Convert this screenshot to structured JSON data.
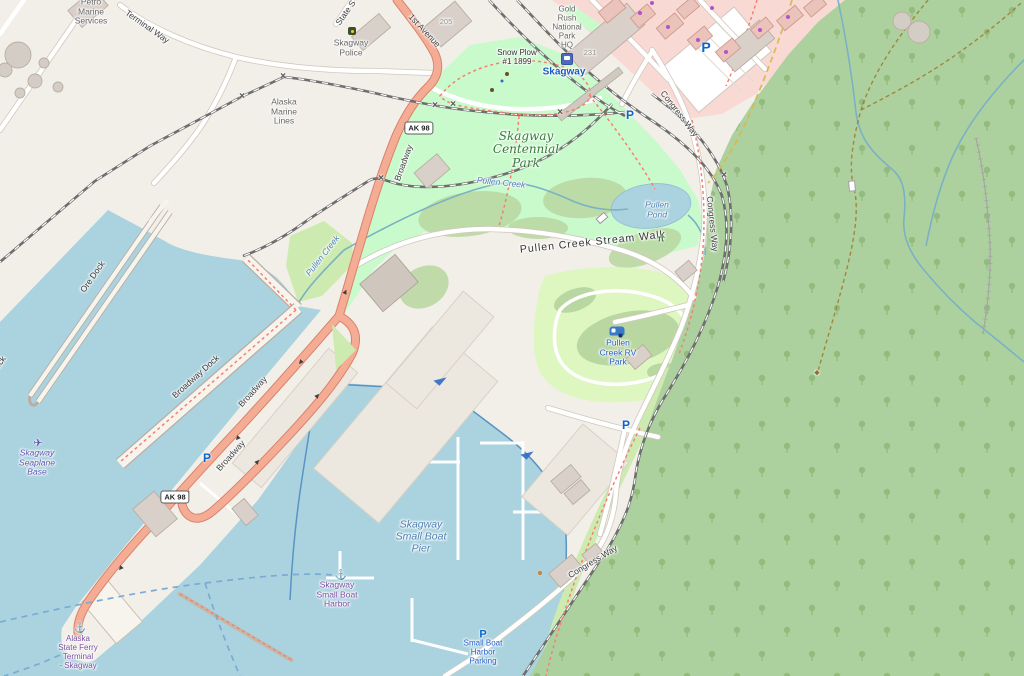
{
  "map": {
    "palette": {
      "land": "#f2efe9",
      "water": "#aad3df",
      "forest": "#add19e",
      "park": "#c8facc",
      "grass": "#cdebb0",
      "scrub": "#b9d7a0",
      "camp_site": "#def6c0",
      "retail_zone": "#f9d9d3",
      "trunk_road": "#f5ac94",
      "minor_road": "#ffffff",
      "building": "#d9d0c9",
      "railway": "#6e6e6e",
      "footpath_dash": "#f87f6f",
      "trail_dash": "#a07830",
      "ferry_route": "#7babd4",
      "parking_blue": "#0a66cc",
      "seamark_purple": "#7a4fa3"
    },
    "labels": [
      {
        "name": "label-petro-marine-services",
        "text": "Petro\nMarine\nServices",
        "x": 91,
        "y": 12,
        "cls": "",
        "size": 8.5
      },
      {
        "name": "label-terminal-way",
        "text": "Terminal Way",
        "x": 147,
        "y": 27,
        "rot": 35,
        "cls": "road"
      },
      {
        "name": "label-state-street",
        "text": "State S",
        "x": 346,
        "y": 13,
        "rot": -55,
        "cls": "road"
      },
      {
        "name": "label-1st-avenue",
        "text": "1st Avenue",
        "x": 424,
        "y": 31,
        "rot": 47,
        "cls": "road"
      },
      {
        "name": "label-alaska-marine-lines",
        "text": "Alaska\nMarine\nLines",
        "x": 284,
        "y": 112,
        "cls": ""
      },
      {
        "name": "label-skagway-police",
        "text": "Skagway\nPolice",
        "x": 351,
        "y": 48,
        "cls": ""
      },
      {
        "name": "label-housenumber-205",
        "text": "205",
        "x": 446,
        "y": 22,
        "cls": "num",
        "size": 7.5
      },
      {
        "name": "label-housenumber-231",
        "text": "231",
        "x": 590,
        "y": 53,
        "cls": "num",
        "size": 7.5
      },
      {
        "name": "label-gold-rush-national-park-hq",
        "text": "Gold\nRush\nNational\nPark\nHQ",
        "x": 567,
        "y": 28,
        "cls": "",
        "size": 8
      },
      {
        "name": "label-skagway-station",
        "text": "Skagway",
        "x": 564,
        "y": 72,
        "cls": "station",
        "size": 10
      },
      {
        "name": "label-snow-plow",
        "text": "Snow Plow\n#1 1899",
        "x": 517,
        "y": 58,
        "cls": "dark",
        "size": 8
      },
      {
        "name": "label-congress-way-north",
        "text": "Congress Way",
        "x": 679,
        "y": 114,
        "rot": 52,
        "cls": "road"
      },
      {
        "name": "label-congress-way-mid",
        "text": "Congress Way",
        "x": 712,
        "y": 224,
        "rot": 84,
        "cls": "road"
      },
      {
        "name": "label-congress-way-south",
        "text": "Congress Way",
        "x": 593,
        "y": 562,
        "rot": -31,
        "cls": "road"
      },
      {
        "name": "label-skagway-centennial-park",
        "text": "Skagway\nCentennial\nPark",
        "x": 526,
        "y": 150,
        "cls": "park",
        "size": 12
      },
      {
        "name": "label-pullen-creek-upper",
        "text": "Pullen Creek",
        "x": 501,
        "y": 183,
        "rot": 6,
        "cls": "water"
      },
      {
        "name": "label-pullen-creek-lower",
        "text": "Pullen Creek",
        "x": 323,
        "y": 256,
        "rot": -52,
        "cls": "water"
      },
      {
        "name": "label-pullen-pond",
        "text": "Pullen\nPond",
        "x": 657,
        "y": 210,
        "cls": "water"
      },
      {
        "name": "label-pullen-creek-stream-walk",
        "text": "Pullen Creek Stream Walk",
        "x": 593,
        "y": 243,
        "rot": -6,
        "cls": "dark",
        "size": 10.5,
        "ls": 1
      },
      {
        "name": "label-pullen-creek-rv-park",
        "text": "Pullen\nCreek RV\nPark",
        "x": 618,
        "y": 353,
        "cls": "transport"
      },
      {
        "name": "label-ore-dock",
        "text": "Ore Dock",
        "x": 93,
        "y": 277,
        "rot": -55,
        "cls": "dark"
      },
      {
        "name": "label-ore-dock-2",
        "text": "Ore Dock",
        "x": -6,
        "y": 372,
        "rot": -55,
        "cls": "dark"
      },
      {
        "name": "label-broadway-dock",
        "text": "Broadway Dock",
        "x": 196,
        "y": 377,
        "rot": -42,
        "cls": "dark"
      },
      {
        "name": "label-broadway-upper",
        "text": "Broadway",
        "x": 404,
        "y": 163,
        "rot": -70,
        "cls": "road"
      },
      {
        "name": "label-broadway-mid",
        "text": "Broadway",
        "x": 253,
        "y": 392,
        "rot": -48,
        "cls": "road"
      },
      {
        "name": "label-broadway-lower",
        "text": "Broadway",
        "x": 231,
        "y": 456,
        "rot": -48,
        "cls": "road"
      },
      {
        "name": "label-skagway-seaplane-base",
        "text": "Skagway\nSeaplane\nBase",
        "x": 37,
        "y": 463,
        "cls": "seaplane"
      },
      {
        "name": "label-alaska-state-ferry-terminal",
        "text": "Alaska\nState Ferry\nTerminal\n- Skagway",
        "x": 78,
        "y": 653,
        "cls": "seamark",
        "size": 8
      },
      {
        "name": "label-skagway-small-boat-harbor",
        "text": "Skagway\nSmall Boat\nHarbor",
        "x": 337,
        "y": 595,
        "cls": "seamark"
      },
      {
        "name": "label-skagway-small-boat-pier",
        "text": "Skagway\nSmall Boat\nPier",
        "x": 421,
        "y": 537,
        "cls": "water-big",
        "size": 10.5
      },
      {
        "name": "label-small-boat-harbor-parking",
        "text": "Small Boat\nHarbor\nParking",
        "x": 483,
        "y": 653,
        "cls": "transport",
        "size": 8
      }
    ],
    "shields": [
      {
        "name": "ak98-shield-north",
        "text": "AK 98",
        "x": 419,
        "y": 128
      },
      {
        "name": "ak98-shield-south",
        "text": "AK 98",
        "x": 175,
        "y": 497
      }
    ],
    "icons": [
      {
        "name": "parking-icon",
        "type": "parking",
        "text": "P",
        "x": 706,
        "y": 47,
        "size": 14
      },
      {
        "name": "parking-icon",
        "type": "parking",
        "text": "P",
        "x": 630,
        "y": 115,
        "size": 12
      },
      {
        "name": "parking-icon",
        "type": "parking",
        "text": "P",
        "x": 207,
        "y": 458,
        "size": 12
      },
      {
        "name": "parking-icon",
        "type": "parking",
        "text": "P",
        "x": 626,
        "y": 425,
        "size": 12
      },
      {
        "name": "parking-icon",
        "type": "parking",
        "text": "P",
        "x": 483,
        "y": 635,
        "size": 11
      },
      {
        "name": "police-icon",
        "type": "police",
        "x": 352,
        "y": 31
      },
      {
        "name": "train-station-icon",
        "type": "station",
        "x": 567,
        "y": 59
      },
      {
        "name": "seaplane-icon",
        "type": "glyph",
        "glyph": "✈",
        "color": "#5b55b0",
        "x": 38,
        "y": 444,
        "size": 11
      },
      {
        "name": "anchor-icon-ferry-terminal",
        "type": "glyph",
        "glyph": "⚓",
        "color": "#7a4fa3",
        "x": 80,
        "y": 629,
        "size": 10
      },
      {
        "name": "anchor-icon-small-boat-harbor",
        "type": "glyph",
        "glyph": "⚓",
        "color": "#7a4fa3",
        "x": 341,
        "y": 576,
        "size": 10
      },
      {
        "name": "caravan-icon",
        "type": "caravan",
        "x": 617,
        "y": 331
      },
      {
        "name": "picnic-table-icon",
        "type": "glyph",
        "glyph": "π",
        "color": "#3e7d3e",
        "x": 661,
        "y": 239,
        "size": 9,
        "bold": true
      },
      {
        "name": "slipway-icon",
        "type": "slipway",
        "x": 440,
        "y": 379
      },
      {
        "name": "slipway-icon",
        "type": "slipway",
        "x": 527,
        "y": 453
      },
      {
        "name": "artwork-icon",
        "type": "glyph",
        "glyph": "◆",
        "color": "#8d6e3f",
        "x": 817,
        "y": 373,
        "size": 7
      },
      {
        "name": "waste-basket-icon",
        "type": "dot",
        "color": "#6b4c2c",
        "x": 507,
        "y": 74,
        "size": 4
      },
      {
        "name": "drinking-fountain-icon",
        "type": "dot",
        "color": "#2f6cc4",
        "x": 502,
        "y": 81,
        "size": 3
      },
      {
        "name": "bench-icon",
        "type": "dot",
        "color": "#6b4c2c",
        "x": 492,
        "y": 90,
        "size": 4
      },
      {
        "name": "shop-icon",
        "type": "dot",
        "color": "#b254c8",
        "x": 640,
        "y": 13,
        "size": 4
      },
      {
        "name": "shop-icon",
        "type": "dot",
        "color": "#b254c8",
        "x": 668,
        "y": 27,
        "size": 4
      },
      {
        "name": "shop-icon",
        "type": "dot",
        "color": "#b254c8",
        "x": 698,
        "y": 40,
        "size": 4
      },
      {
        "name": "shop-icon",
        "type": "dot",
        "color": "#b254c8",
        "x": 726,
        "y": 52,
        "size": 4
      },
      {
        "name": "shop-icon",
        "type": "dot",
        "color": "#b254c8",
        "x": 760,
        "y": 30,
        "size": 4
      },
      {
        "name": "shop-icon",
        "type": "dot",
        "color": "#b254c8",
        "x": 788,
        "y": 17,
        "size": 4
      },
      {
        "name": "shop-icon",
        "type": "dot",
        "color": "#b254c8",
        "x": 652,
        "y": 3,
        "size": 4
      },
      {
        "name": "shop-icon",
        "type": "dot",
        "color": "#b254c8",
        "x": 712,
        "y": 8,
        "size": 4
      },
      {
        "name": "poi-dot-icon",
        "type": "dot",
        "color": "#d08030",
        "x": 540,
        "y": 573,
        "size": 4
      },
      {
        "name": "footbridge-icon",
        "type": "bridge",
        "x": 602,
        "y": 218,
        "rot": -40
      },
      {
        "name": "footbridge-icon",
        "type": "bridge",
        "x": 852,
        "y": 186,
        "rot": 85
      }
    ],
    "oneway_arrows": [
      {
        "x": 300,
        "y": 362,
        "rot": 130
      },
      {
        "x": 237,
        "y": 438,
        "rot": 130
      },
      {
        "x": 120,
        "y": 568,
        "rot": 130
      },
      {
        "x": 318,
        "y": 396,
        "rot": -50
      },
      {
        "x": 258,
        "y": 462,
        "rot": -50
      },
      {
        "x": 346,
        "y": 292,
        "rot": -65
      }
    ],
    "rail_crossings": [
      {
        "x": 283,
        "y": 77
      },
      {
        "x": 242,
        "y": 97
      },
      {
        "x": 435,
        "y": 106
      },
      {
        "x": 453,
        "y": 105
      },
      {
        "x": 560,
        "y": 113
      },
      {
        "x": 724,
        "y": 176
      },
      {
        "x": 381,
        "y": 179
      }
    ]
  }
}
